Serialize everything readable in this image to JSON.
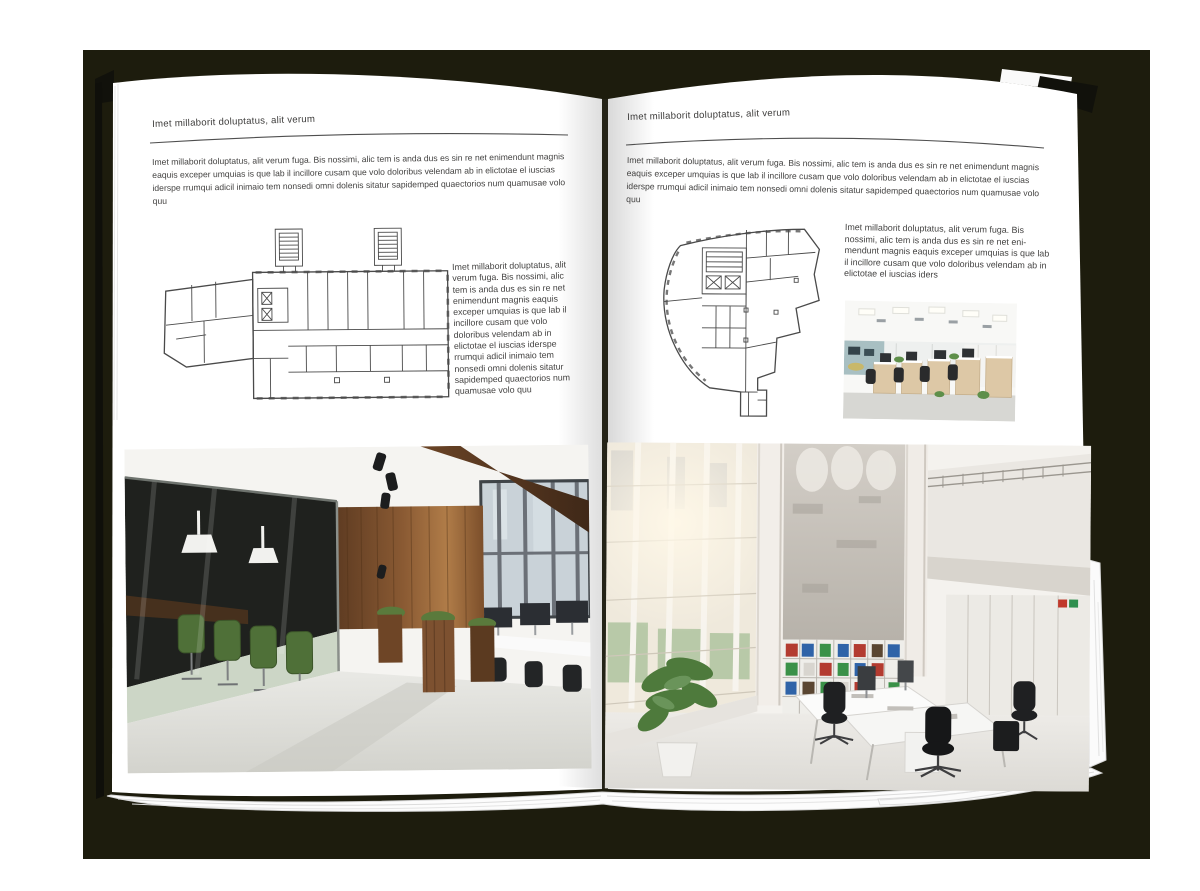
{
  "document": {
    "kind": "magazine-spread-mockup",
    "subject": "interior design portfolio spread with floor plans and office photos"
  },
  "palette": {
    "backdrop": "#1d1c0d",
    "page": "#ffffff",
    "body_text": "#434241",
    "rule_line": "#4f4f4f",
    "plan_line": "#4a4a4a",
    "wood": "#7a4f2c",
    "chair_green": "#4f7038",
    "binder_red": "#b33b30",
    "binder_blue": "#2f63a8",
    "binder_green": "#3a9148"
  },
  "left_page": {
    "header": "Imet millaborit doluptatus, alit verum",
    "intro": "Imet millaborit doluptatus, alit verum fuga. Bis nossimi, alic tem is anda dus es sin re net enimendunt magnis eaquis exceper umquias is que lab il incillore cusam que volo doloribus velendam ab in elictotae el iuscias iderspe rrumqui adicil inimaio tem nonsedi omni dolenis sitatur sapidemped quaectorios num quamusae volo quu",
    "side_text": "Imet millaborit doluptatus, alit verum fuga. Bis nossimi, alic tem is anda dus es sin re net enimendunt magnis eaquis exceper umquias is que lab il incillore cusam que volo doloribus velendam ab in elictotae el iuscias iderspe rrumqui adicil inimaio tem nonsedi omni dolenis sitatur sapidemped quaectorios num quamusae volo quu"
  },
  "right_page": {
    "header": "Imet millaborit doluptatus, alit verum",
    "intro": "Imet millaborit doluptatus, alit verum fuga. Bis nossimi, alic tem is anda dus es sin re net enimendunt magnis eaquis exceper umquias is que lab il incillore cusam que volo doloribus velendam ab in elictotae el iuscias iderspe rrumqui adicil inimaio tem nonsedi omni dolenis sitatur sapidemped quaectorios num quamusae volo quu",
    "side_text": "Imet millaborit doluptatus, alit verum fuga. Bis nossimi, alic tem is anda dus es sin re net eni-mendunt magnis eaquis exceper umquias is que lab il incillore cusam que volo doloribus velendam ab in elictotae el iuscias iders"
  }
}
